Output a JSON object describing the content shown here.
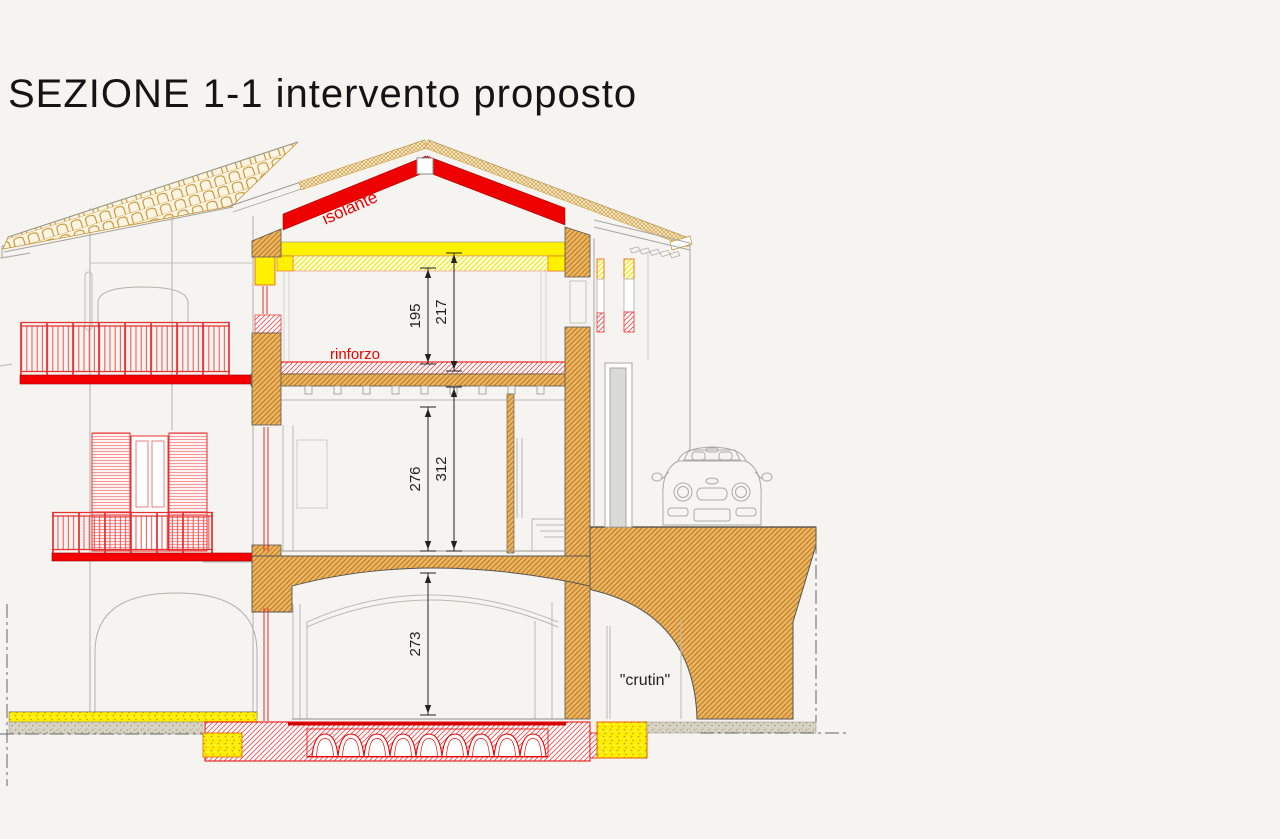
{
  "title": "SEZIONE 1-1 intervento proposto",
  "annotations": {
    "isolante": "isolante",
    "rinforzo": "rinforzo",
    "crutin": "\"crutin\""
  },
  "dimensions": {
    "attic_clear_height": "195",
    "attic_total_height": "217",
    "first_floor_clear_height": "276",
    "first_floor_total_height": "312",
    "cellar_clear_height": "273"
  },
  "colors": {
    "insulation_red": "#ee0000",
    "insulation_yellow": "#fff100",
    "slab_red": "#f40000",
    "masonry_tan": "#e8b35c",
    "reinforcement_red": "#ee2222",
    "tile_tan": "#c8922b",
    "line_gray": "#b3b0a8",
    "background": "#f5f4f0"
  }
}
